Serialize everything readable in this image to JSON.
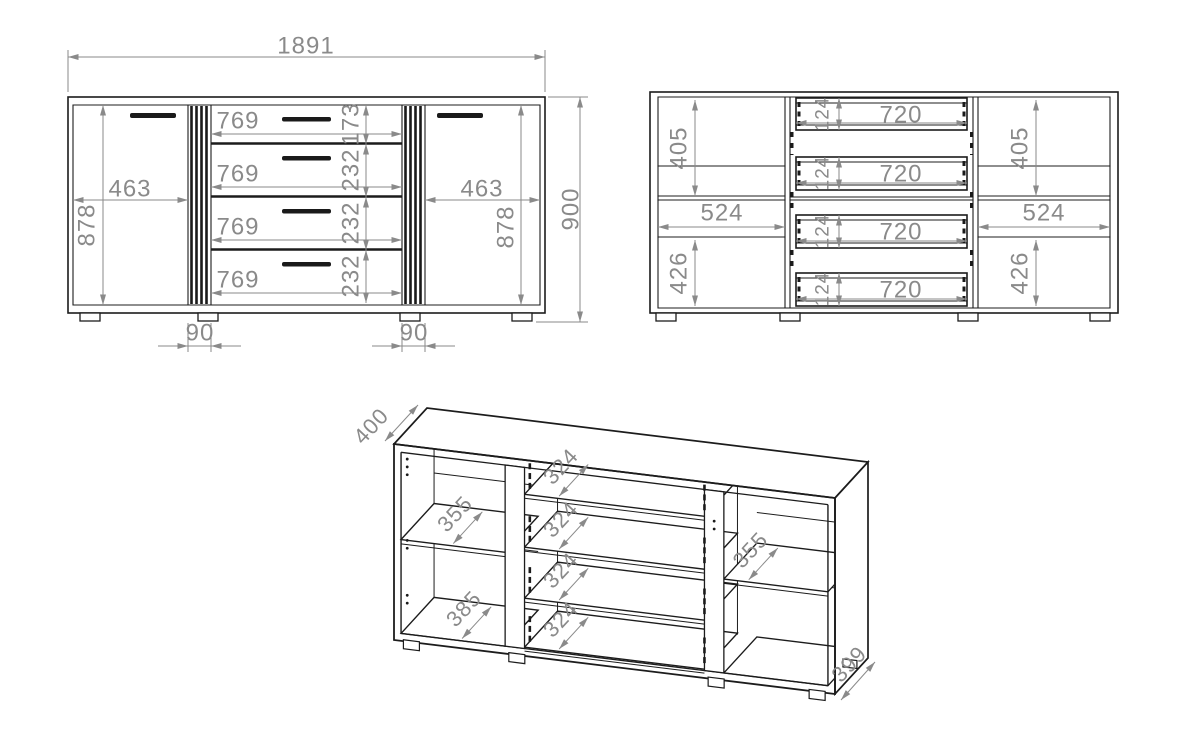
{
  "drawing": {
    "front": {
      "overall_width": "1891",
      "overall_height": "900",
      "door_widths": [
        "463",
        "463"
      ],
      "door_inner_heights": [
        "878",
        "878"
      ],
      "drawer_widths": [
        "769",
        "769",
        "769",
        "769"
      ],
      "drawer_front_heights": [
        "173",
        "232",
        "232",
        "232"
      ],
      "strip_widths": [
        "90",
        "90"
      ]
    },
    "internal": {
      "top_compartment_heights": [
        "405",
        "405"
      ],
      "shelf_widths": [
        "524",
        "524"
      ],
      "bottom_compartment_heights": [
        "426",
        "426"
      ],
      "drawer_box_widths": [
        "720",
        "720",
        "720",
        "720"
      ],
      "drawer_box_heights": [
        "124",
        "124",
        "124",
        "124"
      ]
    },
    "iso": {
      "depth_top": "400",
      "shelf_depth_left": "355",
      "bottom_depth_left": "385",
      "drawer_panel_depths": [
        "324",
        "324",
        "324",
        "324"
      ],
      "shelf_depth_right": "355",
      "bottom_depth_right": "399"
    },
    "line_color": "#1c1c1c",
    "dimension_color": "#8a8a8a"
  }
}
